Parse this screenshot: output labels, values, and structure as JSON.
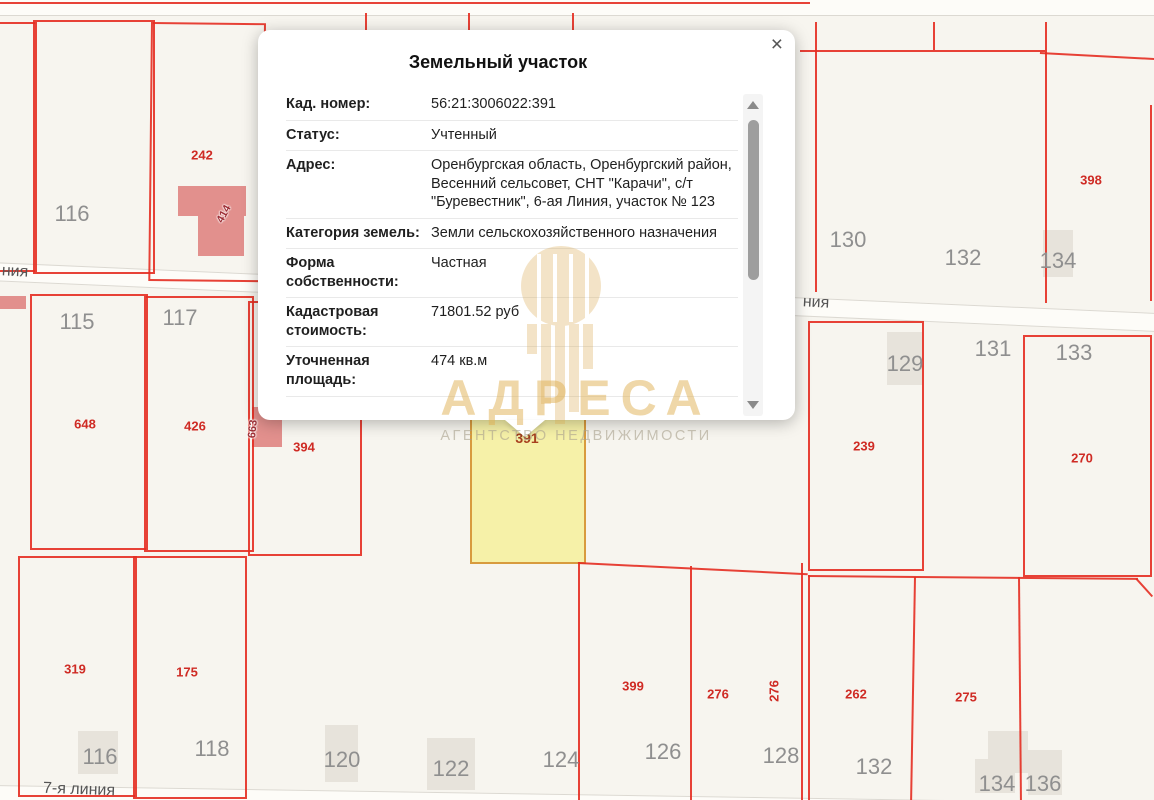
{
  "popup": {
    "title": "Земельный участок",
    "close_label": "×",
    "fields": [
      {
        "label": "Кад. номер:",
        "value": "56:21:3006022:391"
      },
      {
        "label": "Статус:",
        "value": "Учтенный"
      },
      {
        "label": "Адрес:",
        "value": "Оренбургская область, Оренбургский район, Весенний сельсовет, СНТ \"Карачи\", с/т \"Буревестник\", 6-ая Линия, участок № 123"
      },
      {
        "label": "Категория земель:",
        "value": "Земли сельскохозяйственного назначения"
      },
      {
        "label": "Форма собственности:",
        "value": "Частная"
      },
      {
        "label": "Кадастровая стоимость:",
        "value": "71801.52 руб"
      },
      {
        "label": "Уточненная площадь:",
        "value": "474 кв.м"
      }
    ]
  },
  "watermark": {
    "brand": "АДРЕСА",
    "tagline": "АГЕНТСТВО НЕДВИЖИМОСТИ"
  },
  "map": {
    "selected_label": {
      "text": "391",
      "x": 527,
      "y": 438
    },
    "gray_labels": [
      {
        "text": "116",
        "x": 72,
        "y": 214
      },
      {
        "text": "115",
        "x": 77,
        "y": 322
      },
      {
        "text": "117",
        "x": 180,
        "y": 318
      },
      {
        "text": "130",
        "x": 848,
        "y": 240
      },
      {
        "text": "132",
        "x": 963,
        "y": 258
      },
      {
        "text": "134",
        "x": 1058,
        "y": 261
      },
      {
        "text": "129",
        "x": 905,
        "y": 364
      },
      {
        "text": "131",
        "x": 993,
        "y": 349
      },
      {
        "text": "133",
        "x": 1074,
        "y": 353
      },
      {
        "text": "116",
        "x": 100,
        "y": 757
      },
      {
        "text": "118",
        "x": 212,
        "y": 749
      },
      {
        "text": "120",
        "x": 342,
        "y": 760
      },
      {
        "text": "122",
        "x": 451,
        "y": 769
      },
      {
        "text": "124",
        "x": 561,
        "y": 760
      },
      {
        "text": "126",
        "x": 663,
        "y": 752
      },
      {
        "text": "128",
        "x": 781,
        "y": 756
      },
      {
        "text": "132",
        "x": 874,
        "y": 767
      },
      {
        "text": "134",
        "x": 997,
        "y": 784
      },
      {
        "text": "136",
        "x": 1043,
        "y": 784
      }
    ],
    "red_labels": [
      {
        "text": "242",
        "x": 202,
        "y": 155
      },
      {
        "text": "648",
        "x": 85,
        "y": 424
      },
      {
        "text": "426",
        "x": 195,
        "y": 426
      },
      {
        "text": "394",
        "x": 304,
        "y": 447
      },
      {
        "text": "398",
        "x": 1091,
        "y": 180
      },
      {
        "text": "239",
        "x": 864,
        "y": 446
      },
      {
        "text": "270",
        "x": 1082,
        "y": 458
      },
      {
        "text": "319",
        "x": 75,
        "y": 669
      },
      {
        "text": "175",
        "x": 187,
        "y": 672
      },
      {
        "text": "399",
        "x": 633,
        "y": 686
      },
      {
        "text": "276",
        "x": 718,
        "y": 694
      },
      {
        "text": "276",
        "x": 774,
        "y": 691,
        "rot": -90
      },
      {
        "text": "262",
        "x": 856,
        "y": 694
      },
      {
        "text": "275",
        "x": 966,
        "y": 697
      }
    ],
    "road_labels": [
      {
        "text": "ния",
        "x": 15,
        "y": 272,
        "rot": 3
      },
      {
        "text": "ния",
        "x": 816,
        "y": 303,
        "rot": 3
      },
      {
        "text": "7-я линия",
        "x": 79,
        "y": 790,
        "rot": 2
      }
    ],
    "building_labels": [
      {
        "text": "414",
        "x": 224,
        "y": 214,
        "rot": -62
      },
      {
        "text": "663",
        "x": 253,
        "y": 429,
        "rot": -84
      }
    ],
    "colors": {
      "boundary_red": "#e42d21",
      "selected_fill": "#f6f1a8",
      "selected_border": "#d89b3e",
      "watermark_gold": "#d8a64a",
      "label_gray": "#8f8f8f",
      "label_red": "#cf2b24"
    }
  }
}
